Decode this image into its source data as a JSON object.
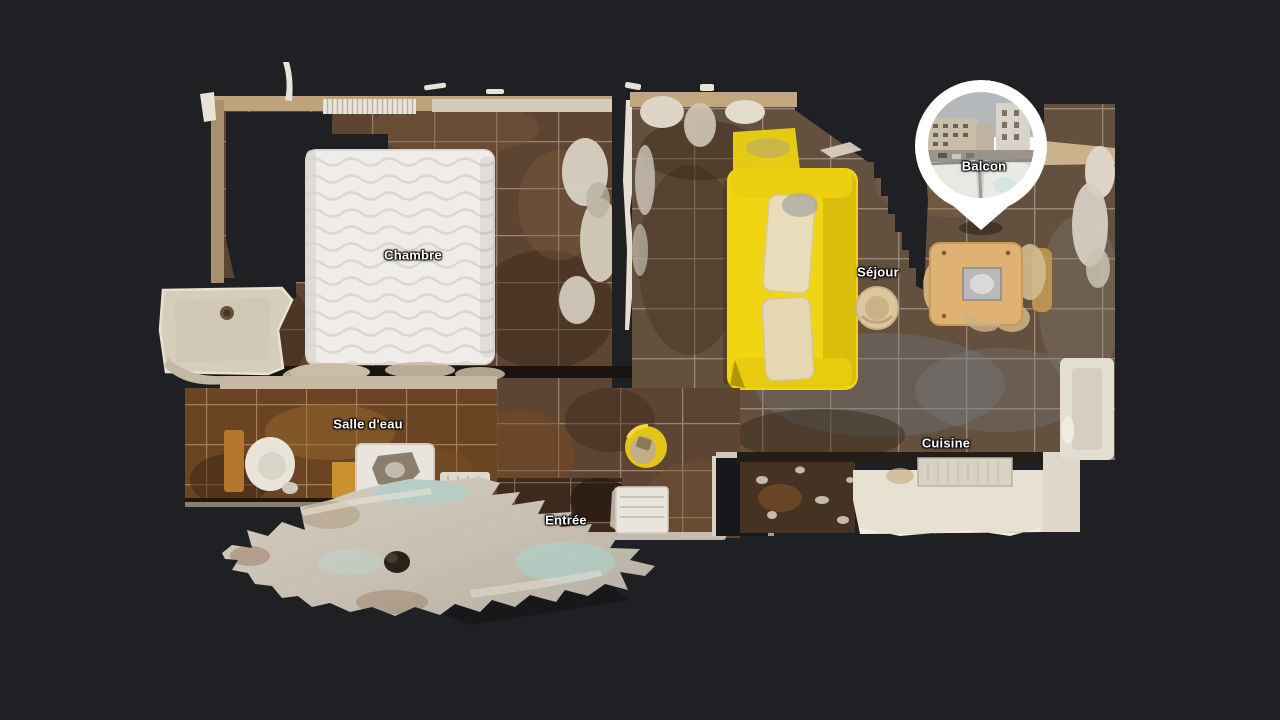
{
  "scene": {
    "description": "3D dollhouse top-down scan view of an apartment",
    "background_color": "#1f2023"
  },
  "rooms": {
    "chambre": {
      "label": "Chambre"
    },
    "sejour": {
      "label": "Séjour"
    },
    "salle_deau": {
      "label": "Salle d'eau"
    },
    "entree": {
      "label": "Entrée"
    },
    "cuisine": {
      "label": "Cuisine"
    },
    "balcon": {
      "label": "Balcon"
    }
  },
  "marker": {
    "room": "balcon",
    "type": "photo-pin",
    "color": "#ffffff"
  },
  "colors": {
    "background": "#1f2023",
    "sofa_yellow": "#f0d512",
    "floor_brown": "#5e4433",
    "mattress_white": "#efecea",
    "pin_white": "#ffffff"
  }
}
